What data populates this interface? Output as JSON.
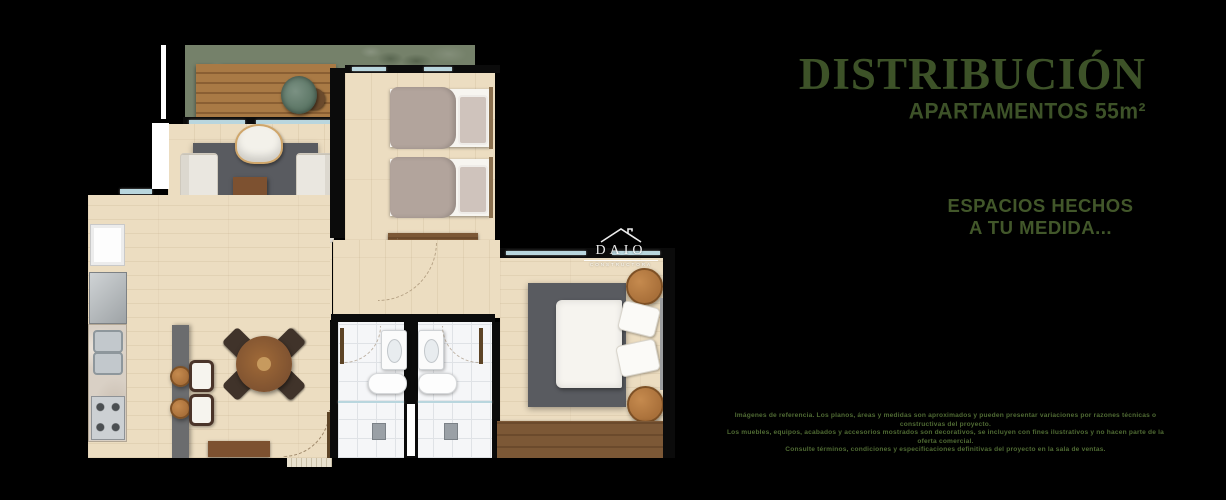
{
  "palette": {
    "bg": "#000000",
    "green-text": "#3d5228",
    "green-text-soft": "#42572a",
    "disclaimer-green": "#4f6a33",
    "wood-floor": "#ecddc1",
    "deck-wood": "#a97a45",
    "deck-wood-dark": "#8a5f33",
    "balcony-green": "#75816a",
    "rug-gray": "#595b60",
    "wall-black": "#0b0b0b",
    "tile-white": "#f5f6f8",
    "tile-line": "#dfe2e6",
    "glass-blue": "#b9d6de",
    "sofa-cream": "#eae7e0",
    "table-brown": "#7d5130",
    "dark-wood": "#7c5836",
    "chair-dark": "#40332a",
    "steel-gray": "#b9bdc0",
    "marble": "#d9d0c5",
    "bed-taupe": "#b2a49c",
    "night-wood": "#a9703a",
    "arc-brown": "#8b7355"
  },
  "header": {
    "title": "DISTRIBUCIÓN",
    "subtitle": "APARTAMENTOS 55m²"
  },
  "tagline": {
    "line1": "ESPACIOS HECHOS",
    "line2": "A TU MEDIDA..."
  },
  "disclaimer": {
    "line1": "Imágenes de referencia. Los planos, áreas y medidas son aproximados y pueden presentar variaciones por razones técnicas o constructivas del proyecto.",
    "line2": "Los muebles, equipos, acabados y accesorios mostrados son decorativos, se incluyen con fines ilustrativos y no hacen parte de la oferta comercial.",
    "line3": "Consulte términos, condiciones y especificaciones definitivas del proyecto en la sala de ventas."
  },
  "watermark": {
    "brand": "DAIO",
    "subtext": "CONSTRUCTORA"
  }
}
